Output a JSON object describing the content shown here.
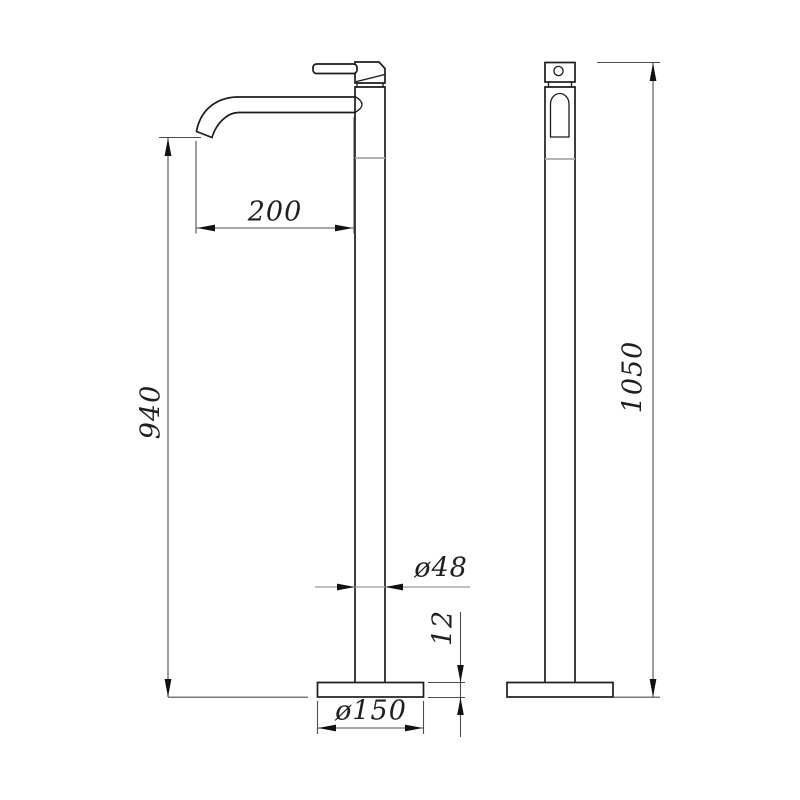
{
  "drawing_type": "faucet-technical-dimension-drawing",
  "colors": {
    "background": "#ffffff",
    "line": "#1c1c1c",
    "dimension": "#4d4d4d",
    "dimension_light": "#9b9b9b",
    "joint": "#a8a8a8",
    "arrow": "#111111",
    "text": "#1f1f1f"
  },
  "dimensions": {
    "spout_reach": "200",
    "spout_outlet_height": "940",
    "overall_height": "1050",
    "column_diameter": "ø48",
    "base_thickness": "12",
    "base_diameter": "ø150"
  }
}
